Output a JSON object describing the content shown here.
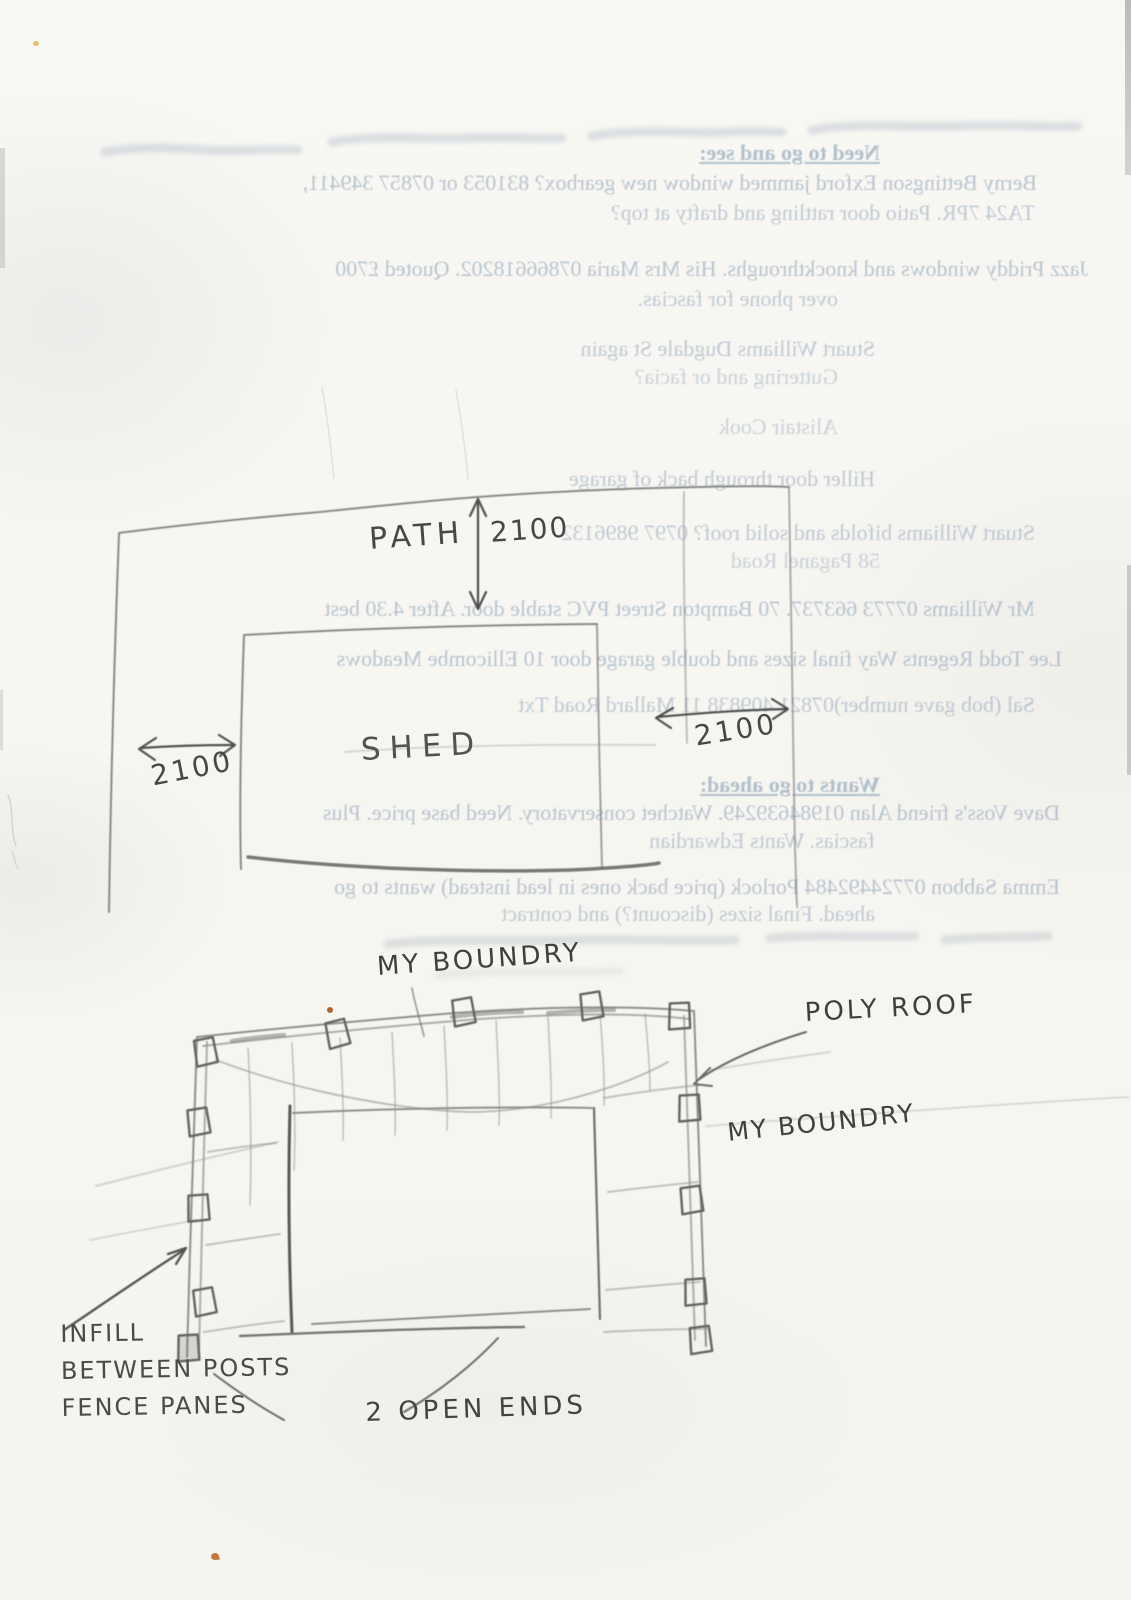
{
  "document_kind": "scanned builder's note page: pencil site sketches with mirrored bleed-through typed notes",
  "bleed": {
    "mirrored": true,
    "lines": [
      "Need to go and see:",
      "Berny Bettingson Exford jammed window new gearbox? 831053 or 07857 349411,",
      "TA24 7PR. Patio door rattling and drafty at top?",
      "Jazz Priddy windows and knockthroughs. His Mrs Maria 07866618202. Quoted £700",
      "over phone for fascias.",
      "Stuart Williams Dugdale St again",
      "Guttering and or facia?",
      "Alistair Cook",
      "Hiller door through back of garage",
      "Stuart Williams bifolds and solid roof? 0797 9896132",
      "58 Paganel Road",
      "Mr Williams 07773 663737. 70 Bampton Street PVC stable door. After 4.30 best",
      "Lee Todd Regents Way final sizes and double garage door 10 Ellicombe Meadows",
      "Sal (bob gave number)07821 409838 11 Mallard Road Txt",
      "Wants to go ahead:",
      "Dave Voss's friend Alan 01984639249. Watchet conservatory. Need base price. Plus",
      "fascias. Wants Edwardian",
      "Emma Sabbon 07724492484 Porlock (price back ones in lead instead) wants to go",
      "ahead. Final sizes (discount?) and contract"
    ]
  },
  "shed_plan": {
    "path_label": "PATH",
    "path_dimension": "2100",
    "shed_label": "SHED",
    "left_gap_dimension": "2100",
    "right_gap_dimension": "2100"
  },
  "fence_sketch": {
    "top_boundary_label": "MY BOUNDRY",
    "poly_roof_label": "POLY ROOF",
    "right_boundary_label": "MY BOUNDRY",
    "infill_note": [
      "INFILL",
      "BETWEEN POSTS",
      "FENCE PANES"
    ],
    "open_ends_note": "2 OPEN ENDS"
  }
}
